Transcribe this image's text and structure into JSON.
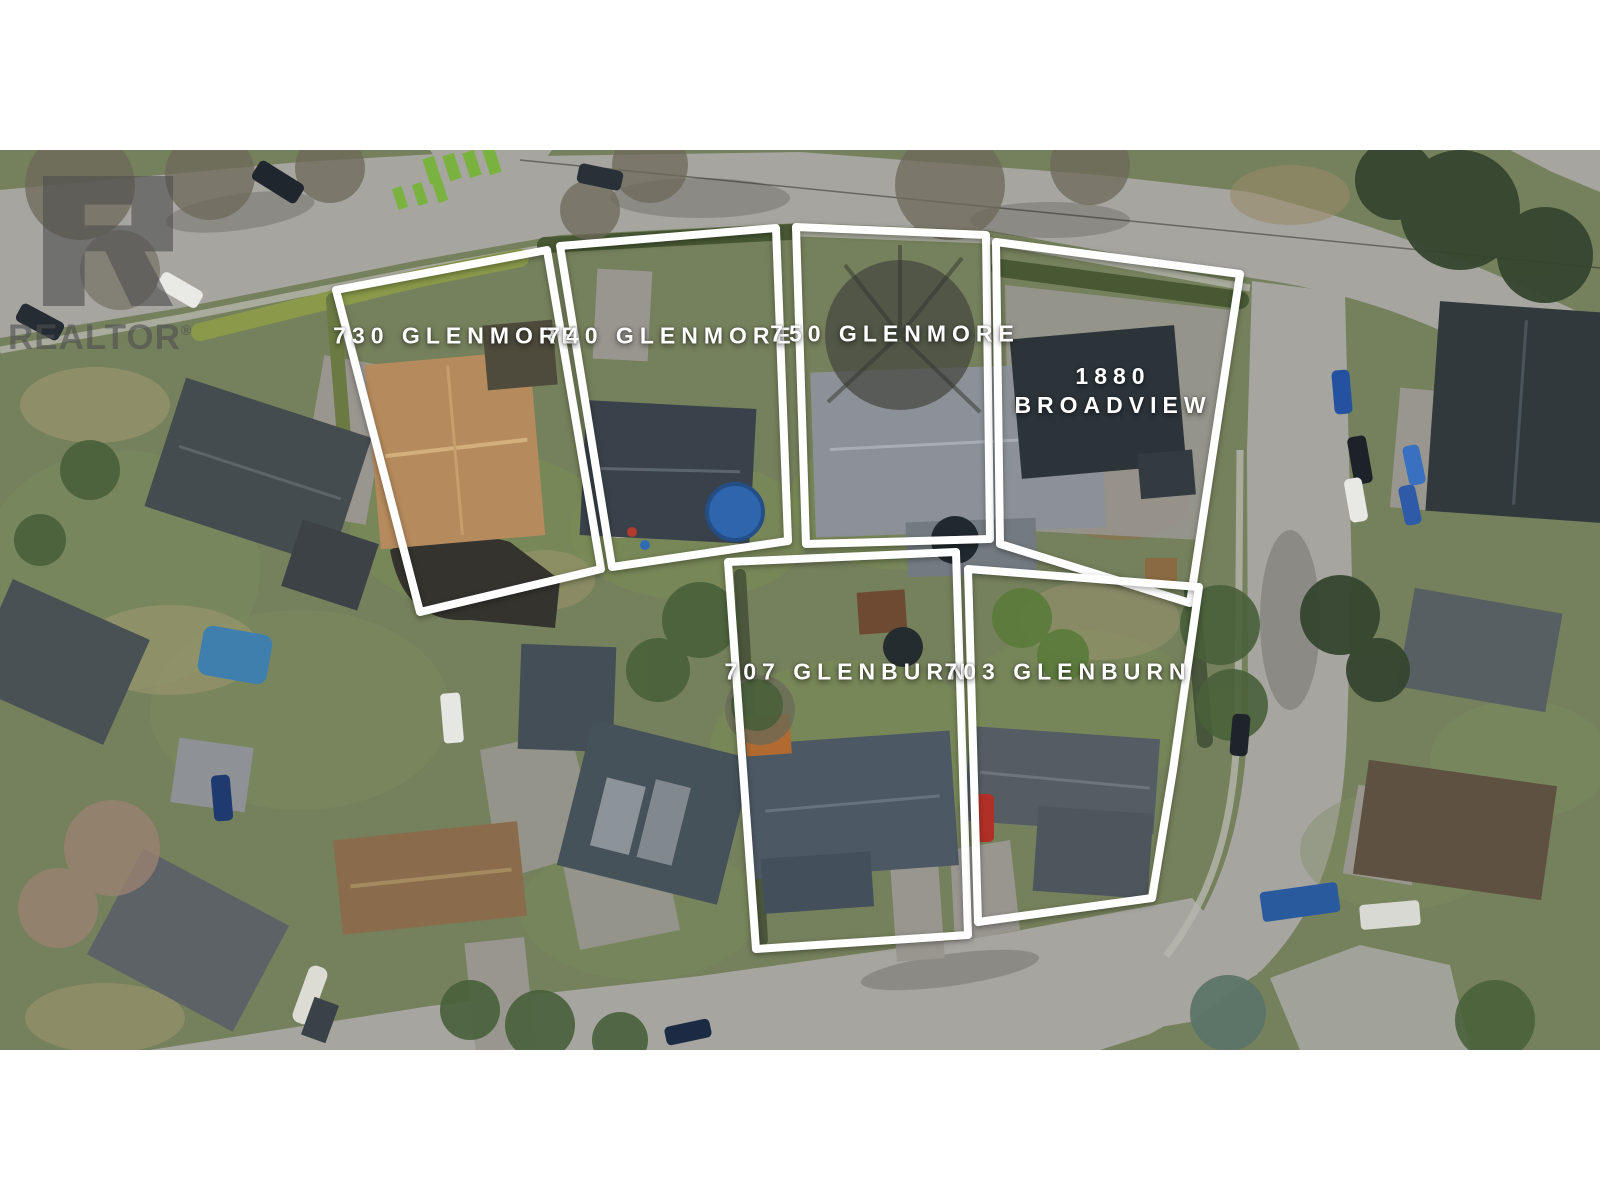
{
  "watermark": {
    "brand": "REALTOR",
    "registered_mark": "®"
  },
  "photo": {
    "description": "Aerial drone view of a residential neighbourhood with six outlined property parcels"
  },
  "parcels": [
    {
      "id": "730-glenmore",
      "label": "730 GLENMORE"
    },
    {
      "id": "740-glenmore",
      "label": "740 GLENMORE"
    },
    {
      "id": "750-glenmore",
      "label": "750 GLENMORE"
    },
    {
      "id": "1880-broadview",
      "label_line1": "1880",
      "label_line2": "BROADVIEW"
    },
    {
      "id": "707-glenburn",
      "label": "707 GLENBURN"
    },
    {
      "id": "703-glenburn",
      "label": "703 GLENBURN"
    }
  ],
  "colors": {
    "outline": "#ffffff",
    "label-text": "#ffffff",
    "watermark": "#4f4f4f",
    "grass-base": "#75805c",
    "road": "#a6a5a0",
    "crosswalk-green": "#79b23f"
  }
}
